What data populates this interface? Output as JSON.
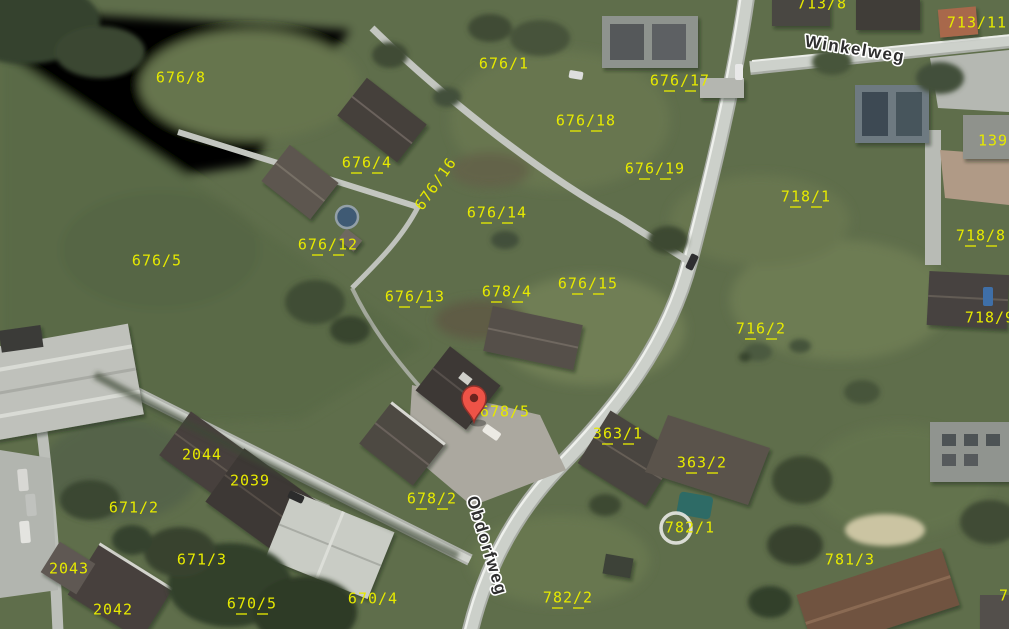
{
  "map": {
    "type": "aerial-cadastral-map",
    "marker": {
      "x": 474,
      "y": 422
    },
    "street_labels": [
      {
        "text": "Winkelweg",
        "x": 855,
        "y": 50,
        "rotation": 9
      },
      {
        "text": "Obdorfweg",
        "x": 486,
        "y": 546,
        "rotation": 73
      }
    ],
    "parcel_labels": [
      {
        "text": "676/8",
        "x": 181,
        "y": 78,
        "dashes": false
      },
      {
        "text": "676/1",
        "x": 504,
        "y": 64,
        "dashes": false
      },
      {
        "text": "676/17",
        "x": 680,
        "y": 81,
        "dashes": true
      },
      {
        "text": "676/18",
        "x": 586,
        "y": 121,
        "dashes": true
      },
      {
        "text": "676/19",
        "x": 655,
        "y": 169,
        "dashes": true
      },
      {
        "text": "713/8",
        "x": 822,
        "y": 4,
        "dashes": false
      },
      {
        "text": "713/11",
        "x": 977,
        "y": 23,
        "dashes": false
      },
      {
        "text": "1397",
        "x": 998,
        "y": 141,
        "dashes": false
      },
      {
        "text": "718/1",
        "x": 806,
        "y": 197,
        "dashes": true
      },
      {
        "text": "718/8",
        "x": 981,
        "y": 236,
        "dashes": true
      },
      {
        "text": "716/2",
        "x": 761,
        "y": 329,
        "dashes": true
      },
      {
        "text": "718/9",
        "x": 990,
        "y": 318,
        "dashes": false
      },
      {
        "text": "676/4",
        "x": 367,
        "y": 163,
        "dashes": true
      },
      {
        "text": "676/16",
        "x": 436,
        "y": 184,
        "rotation": -55,
        "dashes": false
      },
      {
        "text": "676/14",
        "x": 497,
        "y": 213,
        "dashes": true
      },
      {
        "text": "676/12",
        "x": 328,
        "y": 245,
        "dashes": true
      },
      {
        "text": "676/5",
        "x": 157,
        "y": 261,
        "dashes": false
      },
      {
        "text": "676/13",
        "x": 415,
        "y": 297,
        "dashes": true
      },
      {
        "text": "678/4",
        "x": 507,
        "y": 292,
        "dashes": true
      },
      {
        "text": "676/15",
        "x": 588,
        "y": 284,
        "dashes": true
      },
      {
        "text": "678/5",
        "x": 505,
        "y": 412,
        "dashes": false
      },
      {
        "text": "363/1",
        "x": 618,
        "y": 434,
        "dashes": true
      },
      {
        "text": "363/2",
        "x": 702,
        "y": 463,
        "dashes": true
      },
      {
        "text": "2044",
        "x": 202,
        "y": 455,
        "dashes": false
      },
      {
        "text": "2039",
        "x": 250,
        "y": 481,
        "dashes": false
      },
      {
        "text": "671/2",
        "x": 134,
        "y": 508,
        "dashes": false
      },
      {
        "text": "671/3",
        "x": 202,
        "y": 560,
        "dashes": false
      },
      {
        "text": "2043",
        "x": 69,
        "y": 569,
        "dashes": false
      },
      {
        "text": "2042",
        "x": 113,
        "y": 610,
        "dashes": false
      },
      {
        "text": "670/5",
        "x": 252,
        "y": 604,
        "dashes": true
      },
      {
        "text": "670/4",
        "x": 373,
        "y": 599,
        "dashes": false
      },
      {
        "text": "678/2",
        "x": 432,
        "y": 499,
        "dashes": true
      },
      {
        "text": "782/2",
        "x": 568,
        "y": 598,
        "dashes": true
      },
      {
        "text": "782/1",
        "x": 690,
        "y": 528,
        "dashes": false
      },
      {
        "text": "781/3",
        "x": 850,
        "y": 560,
        "dashes": false
      },
      {
        "text": "7",
        "x": 1004,
        "y": 596,
        "dashes": false
      }
    ],
    "colors": {
      "parcel_line": "#e8eb00",
      "parcel_text": "#e6e900",
      "street_text": "#2e2e2e",
      "street_halo": "#ffffff",
      "marker_fill": "#ee5347",
      "marker_stroke": "#93312a",
      "marker_dot": "#6b241f"
    }
  }
}
